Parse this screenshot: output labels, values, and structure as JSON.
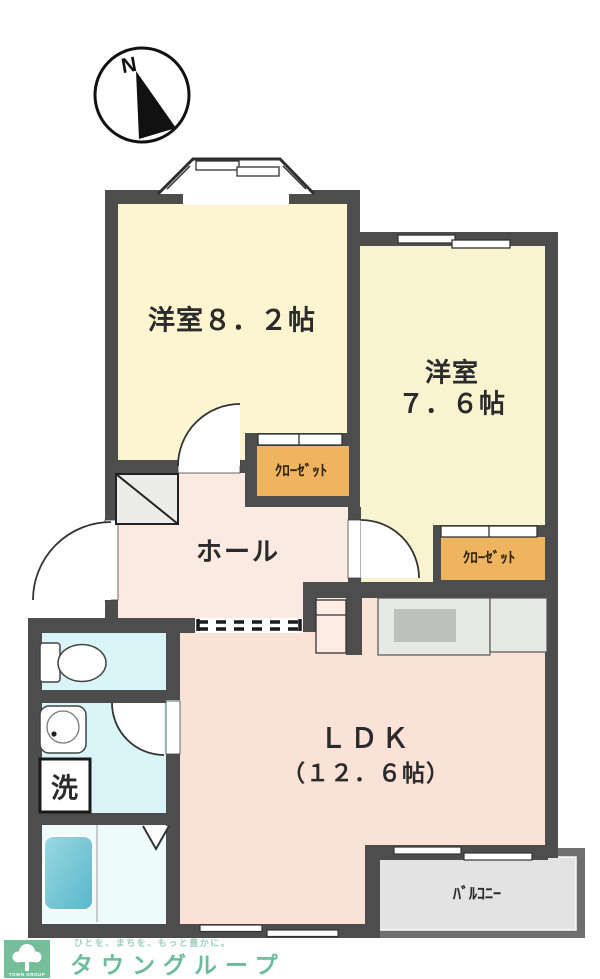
{
  "compass": {
    "label": "N"
  },
  "rooms": {
    "western1": {
      "label": "洋室８．２帖"
    },
    "western2": {
      "label_line1": "洋室",
      "label_line2": "７．６帖"
    },
    "hall": {
      "label": "ホール"
    },
    "ldk": {
      "label": "ＬＤＫ",
      "size": "（１２．６帖）"
    },
    "closet1": {
      "label": "ｸﾛｰｾﾞｯﾄ"
    },
    "closet2": {
      "label": "ｸﾛｰｾﾞｯﾄ"
    },
    "laundry": {
      "label": "洗"
    },
    "balcony": {
      "label": "ﾊﾞﾙｺﾆｰ"
    }
  },
  "footer": {
    "tagline": "ひとを、まちを、もっと豊かに。",
    "brand": "タウングループ",
    "logo_text": "TOWN GROUP"
  },
  "colors": {
    "wall": "#4d4d4d",
    "room_yellow": "#fcf5cf",
    "room_pink_ldk": "#fae2d7",
    "room_pink_hall": "#fbeae1",
    "closet_orange": "#eeb45f",
    "sanitary_cyan": "#daf5f7",
    "bathtub_teal": "#57b7ca",
    "kitchen_gray": "#e6e9e5",
    "balcony_gray": "#6f6f6f",
    "logo_green": "#74bf9a"
  }
}
